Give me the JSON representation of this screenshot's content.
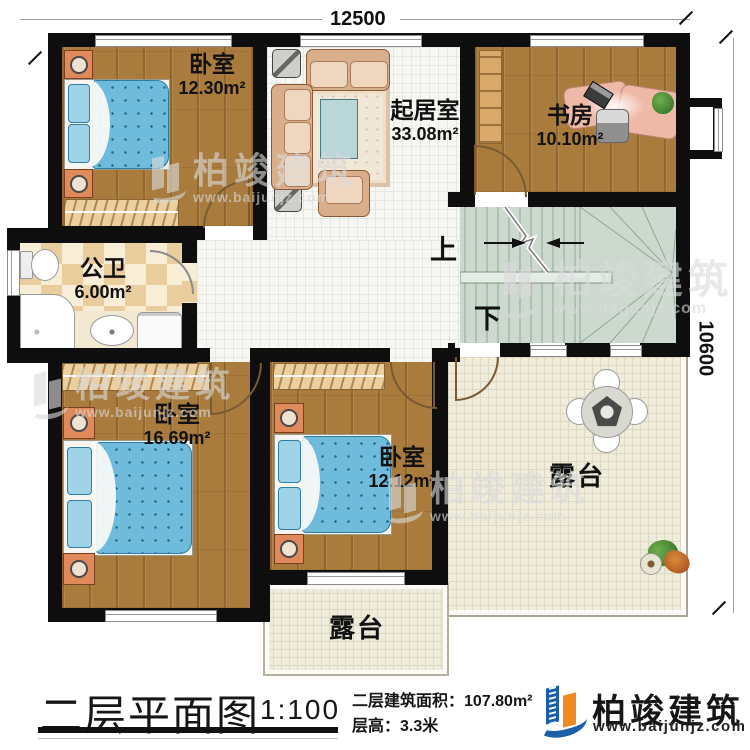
{
  "dimensions": {
    "top": "12500",
    "right": "10600"
  },
  "rooms": [
    {
      "name": "卧室",
      "area": "12.30m²"
    },
    {
      "name": "起居室",
      "area": "33.08m²"
    },
    {
      "name": "书房",
      "area": "10.10m²"
    },
    {
      "name": "公卫",
      "area": "6.00m²"
    },
    {
      "name": "卧室",
      "area": "16.69m²"
    },
    {
      "name": "卧室",
      "area": "12.12m²"
    },
    {
      "name": "露台",
      "area": ""
    },
    {
      "name": "露台",
      "area": ""
    }
  ],
  "stairs": {
    "up": "上",
    "down": "下"
  },
  "watermark": {
    "brand": "柏竣建筑",
    "url": "www.baijunjz.com"
  },
  "titleblock": {
    "title": "二层平面图",
    "scale": "1:100",
    "area_label": "二层建筑面积：",
    "area_value": "107.80m²",
    "height_label": "层高：",
    "height_value": "3.3米",
    "brand": "柏竣建筑",
    "brand_url": "www.baijunjz.com"
  },
  "colors": {
    "brand_blue": "#1b5fa8",
    "brand_orange": "#f0891f",
    "wall": "#0e0e0e",
    "bed_blue": "#6ebbdc"
  }
}
